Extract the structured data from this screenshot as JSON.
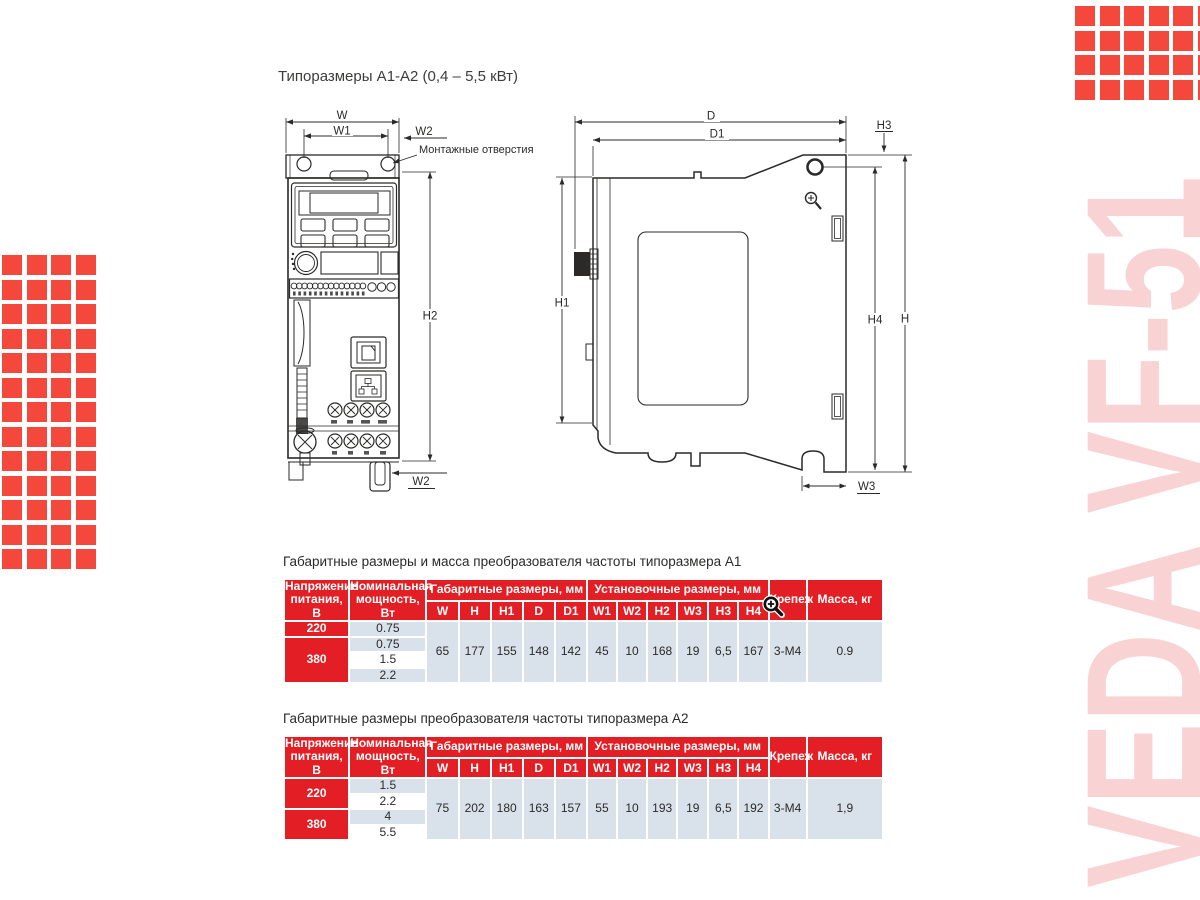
{
  "page": {
    "title": "Типоразмеры A1-A2 (0,4 – 5,5 кВт)"
  },
  "brand": {
    "vertical_text": "VEDA VF-51"
  },
  "colors": {
    "accent_red": "#f5483c",
    "table_red": "#e31e24",
    "row_blue": "#d9e2ea",
    "pink": "#f9d2d3",
    "line": "#2b2a29"
  },
  "icons": {
    "table_cursor": "magnifier-plus-cursor",
    "drawing_cursor": "magnifier-plus-cursor"
  },
  "deco": {
    "square": 20,
    "gap": 4.5,
    "left": {
      "cols": 4,
      "rows": 13,
      "x": 2,
      "y": 255
    },
    "top_right": {
      "cols": 6,
      "rows": 4,
      "x": 1075,
      "y": 6
    }
  },
  "drawing": {
    "front": {
      "labels": {
        "w": "W",
        "w1": "W1",
        "w2_top": "W2",
        "mounting_holes": "Монтажные отверстия",
        "h2": "H2",
        "w2_bottom": "W2"
      }
    },
    "side": {
      "labels": {
        "d": "D",
        "d1": "D1",
        "h3": "H3",
        "h1": "H1",
        "h4": "H4",
        "h": "H",
        "w3": "W3"
      }
    }
  },
  "table_a1": {
    "caption": "Габаритные размеры и масса преобразователя частоты типоразмера А1",
    "col_voltage": "Напряжение питания, В",
    "col_power": "Номинальная мощность, Вт",
    "group_overall": "Габаритные размеры, мм",
    "group_mounting": "Установочные размеры, мм",
    "col_fastener": "Крепеж",
    "col_mass": "Масса, кг",
    "sub_overall": [
      "W",
      "H",
      "H1",
      "D",
      "D1"
    ],
    "sub_mounting": [
      "W1",
      "W2",
      "H2",
      "W3",
      "H3",
      "H4"
    ],
    "voltage_groups": [
      {
        "voltage": "220",
        "powers": [
          "0.75"
        ]
      },
      {
        "voltage": "380",
        "powers": [
          "0.75",
          "1.5",
          "2.2"
        ]
      }
    ],
    "overall_values": [
      "65",
      "177",
      "155",
      "148",
      "142"
    ],
    "mounting_values": [
      "45",
      "10",
      "168",
      "19",
      "6,5",
      "167"
    ],
    "fastener": "3-М4",
    "mass": "0.9"
  },
  "table_a2": {
    "caption": "Габаритные размеры преобразователя частоты типоразмера А2",
    "col_voltage": "Напряжение питания, В",
    "col_power": "Номинальная мощность, Вт",
    "group_overall": "Габаритные размеры, мм",
    "group_mounting": "Установочные размеры, мм",
    "col_fastener": "Крепеж",
    "col_mass": "Масса, кг",
    "sub_overall": [
      "W",
      "H",
      "H1",
      "D",
      "D1"
    ],
    "sub_mounting": [
      "W1",
      "W2",
      "H2",
      "W3",
      "H3",
      "H4"
    ],
    "voltage_groups": [
      {
        "voltage": "220",
        "powers": [
          "1.5",
          "2.2"
        ]
      },
      {
        "voltage": "380",
        "powers": [
          "4",
          "5.5"
        ]
      }
    ],
    "overall_values": [
      "75",
      "202",
      "180",
      "163",
      "157"
    ],
    "mounting_values": [
      "55",
      "10",
      "193",
      "19",
      "6,5",
      "192"
    ],
    "fastener": "3-М4",
    "mass": "1,9"
  }
}
